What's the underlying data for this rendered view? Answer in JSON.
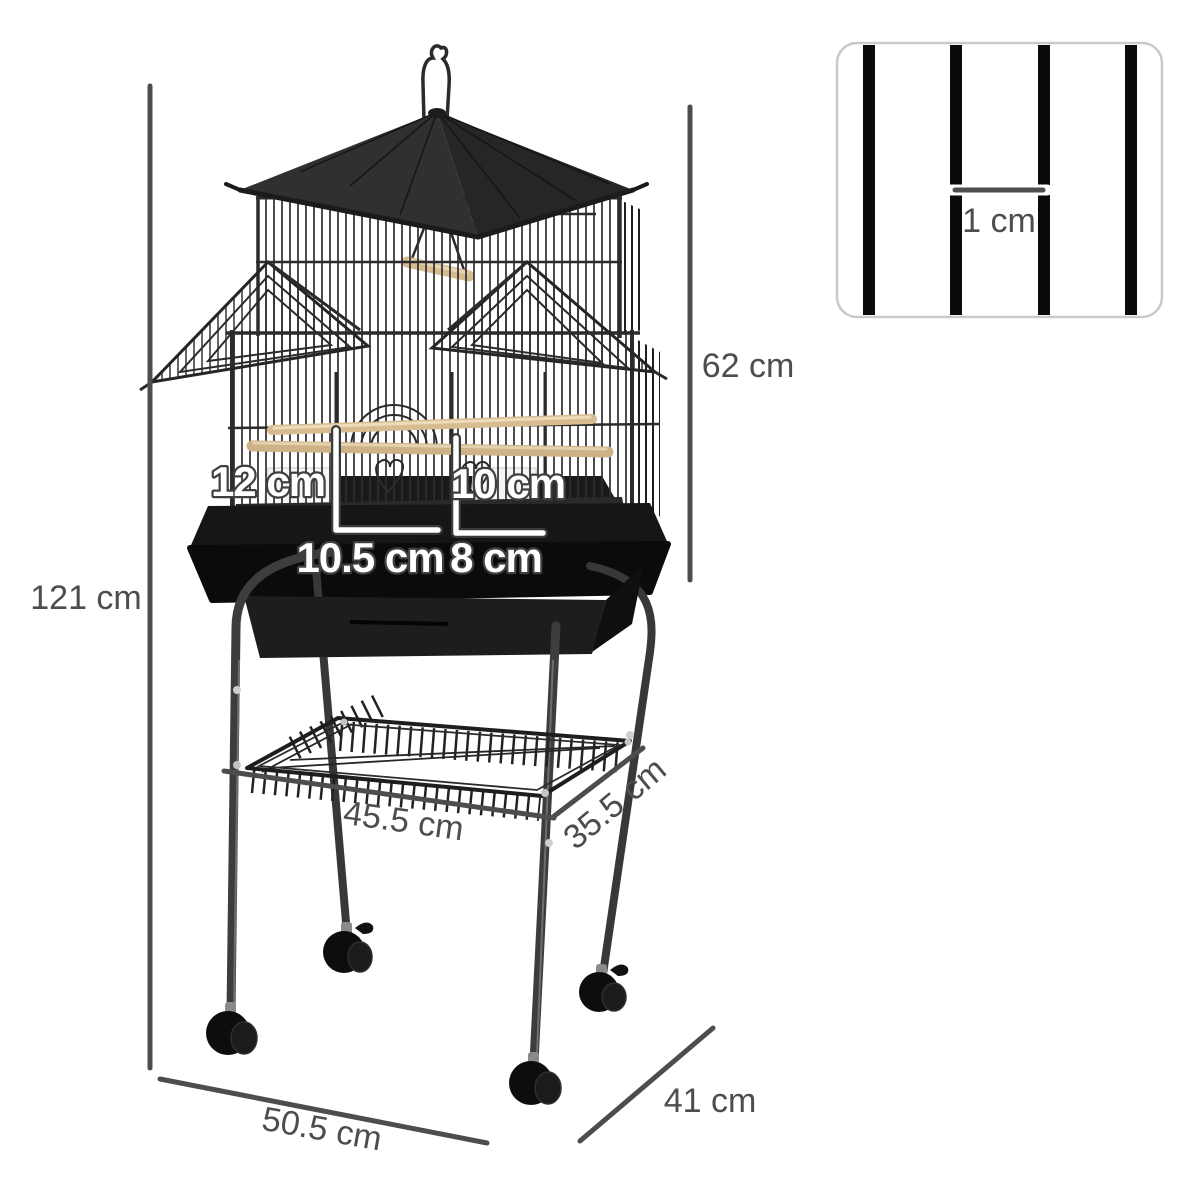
{
  "product": {
    "name": "bird cage with pagoda roof on rolling stand",
    "parts": [
      "hanging hook",
      "pagoda roof",
      "side dormer roofs",
      "wire cage body",
      "wood perches",
      "swing",
      "feeder cups",
      "seed tray",
      "storage shelf basket",
      "caster wheels"
    ]
  },
  "dimensions": {
    "overall_height": "121 cm",
    "cage_height": "62 cm",
    "left_door_height": "12 cm",
    "right_door_height": "10 cm",
    "left_door_width": "10.5 cm",
    "right_door_width": "8 cm",
    "shelf_width": "45.5 cm",
    "shelf_depth": "35.5 cm",
    "base_width": "50.5 cm",
    "base_depth": "41 cm"
  },
  "inset": {
    "bar_spacing_label": "1 cm"
  },
  "colors": {
    "measurement_gray": "#4d4d4d",
    "cage_dark": "#2b2b2b",
    "perch_wood": "#d7bc92",
    "inset_border": "#c9c9c9",
    "white_label_outline": "#3f3f3f",
    "background": "#ffffff"
  }
}
